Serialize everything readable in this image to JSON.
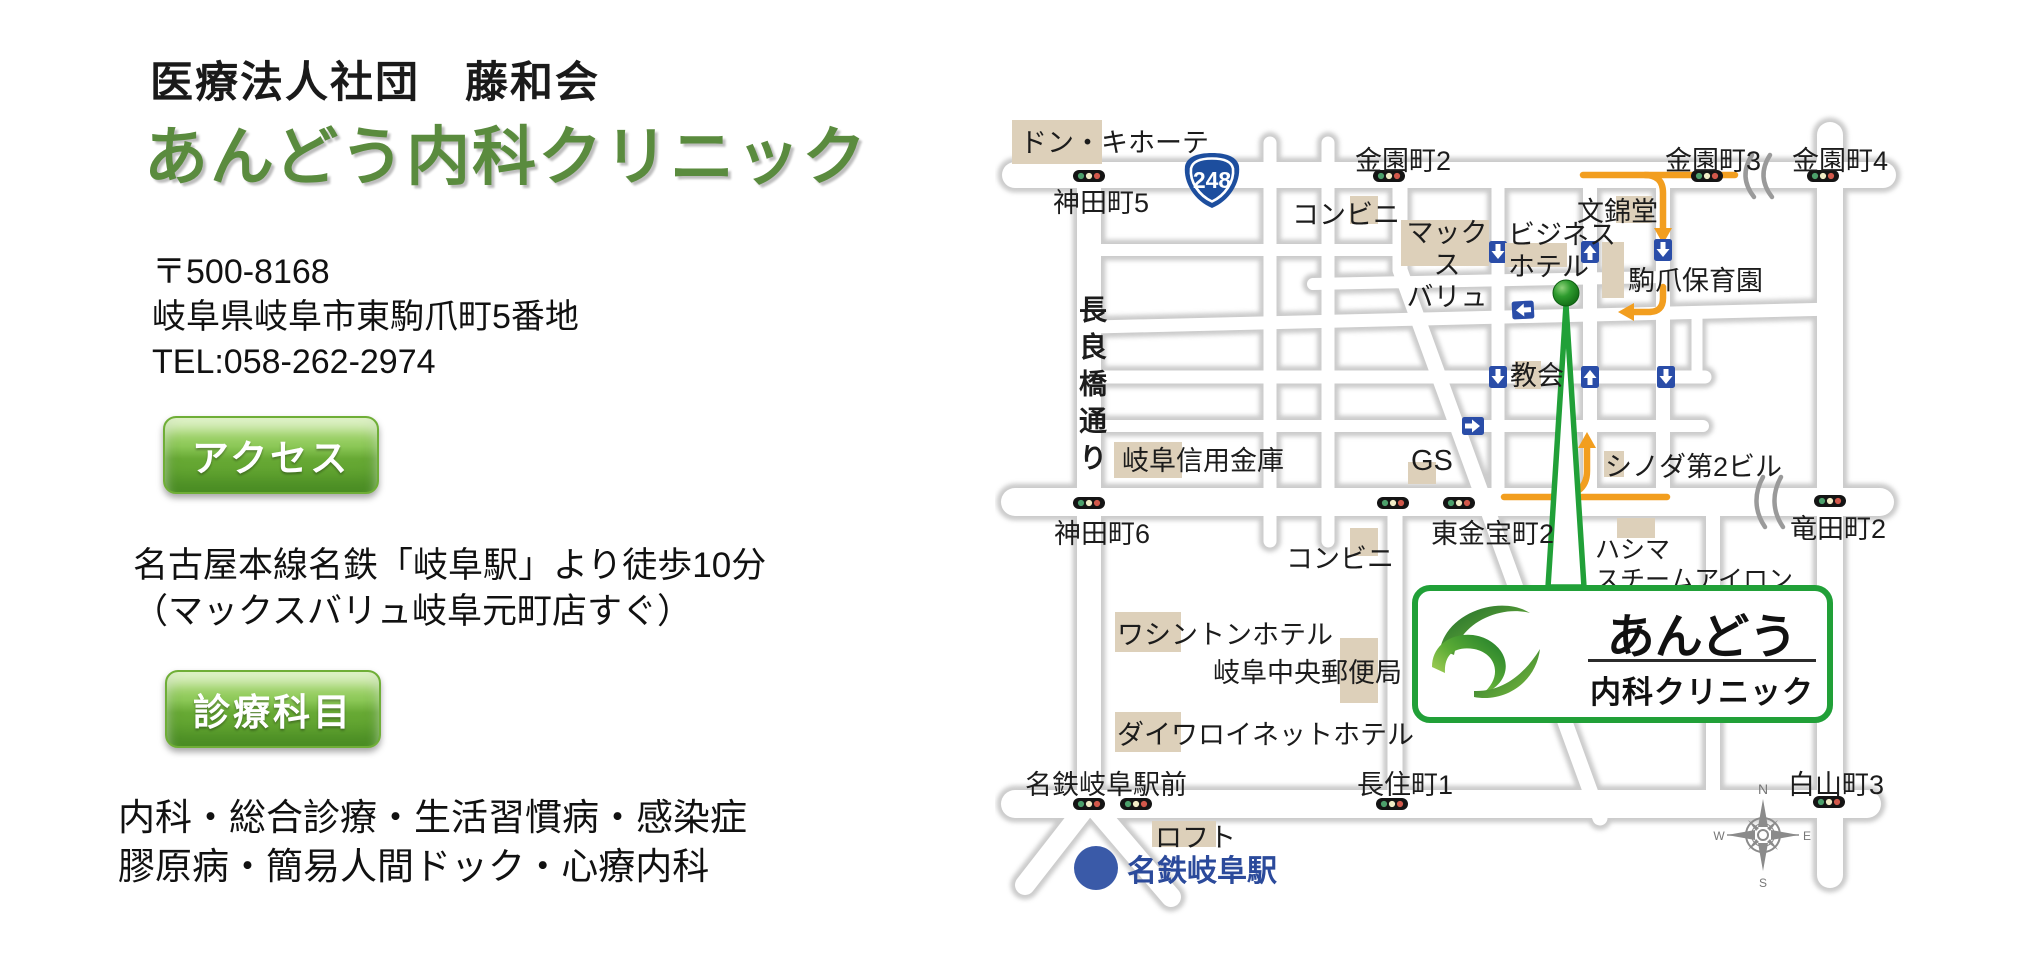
{
  "clinic": {
    "org": "医療法人社団　藤和会",
    "name": "あんどう内科クリニック",
    "postal": "〒500-8168",
    "address": "岐阜県岐阜市東駒爪町5番地",
    "tel": "TEL:058-262-2974",
    "access_button": "アクセス",
    "access_line1": "名古屋本線名鉄「岐阜駅」より徒歩10分",
    "access_line2": "（マックスバリュ岐阜元町店すぐ）",
    "departments_button": "診療科目",
    "departments_line1": "内科・総合診療・生活習慣病・感染症",
    "departments_line2": "膠原病・簡易人間ドック・心療内科"
  },
  "accent": {
    "title_green": "#5A8B3E",
    "button_green": "#6FAE37"
  },
  "map": {
    "route_badge": "248",
    "labels": {
      "donki": "ドン・キホーテ",
      "kanda5": "神田町5",
      "kinzono2": "金園町2",
      "kinzono3": "金園町3",
      "kinzono4": "金園町4",
      "conbini_north": "コンビニ",
      "maxvalu": "マックス\nバリュ",
      "business_hotel": "ビジネス\nホテル",
      "bunkindo": "文錦堂",
      "komazume_hoikuen": "駒爪保育園",
      "nagarabashi_dori": "長良橋通り",
      "kyokai": "教会",
      "gifu_shinkin": "岐阜信用金庫",
      "gs": "GS",
      "kanda6": "神田町6",
      "higashikinpocho2": "東金宝町2",
      "conbini_south": "コンビニ",
      "shinoda_bld": "シノダ第2ビル",
      "tatsutacho2": "竜田町2",
      "hashima": "ハシマ\nスチームアイロン",
      "washington_hotel": "ワシントンホテル",
      "gifu_chuo_post": "岐阜中央郵便局",
      "daiwa_roynet": "ダイワロイネットホテル",
      "meitetsu_ekimae": "名鉄岐阜駅前",
      "nagazumicho1": "長住町1",
      "hakusancho3": "白山町3",
      "loft": "ロフト"
    },
    "station_name": "名鉄岐阜駅",
    "logo_line1": "あんどう",
    "logo_line2": "内科クリニック",
    "compass": {
      "n": "N",
      "e": "E",
      "s": "S",
      "w": "W"
    },
    "colors": {
      "road": "#FFFFFF",
      "road_halo": "#C2C2C2",
      "building_beige": "#DDD0BA",
      "route_orange": "#F29E1F",
      "oneway_blue": "#2A4DA8",
      "pin_green": "#2E9B2E",
      "callout_green": "#21A038",
      "station_blue": "#3A5AA8",
      "badge_blue": "#1D4E9E"
    }
  }
}
